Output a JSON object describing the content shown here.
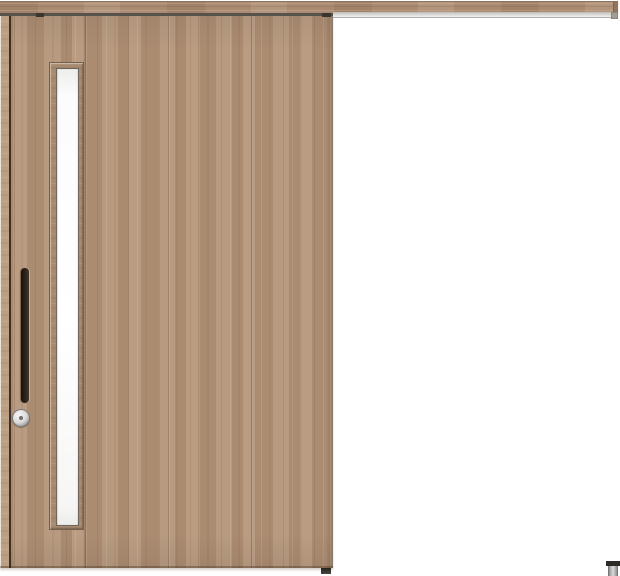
{
  "scene": {
    "type": "product-photo",
    "subject": "single outset sliding wooden door, closed, hung from full-width top rail",
    "background_color": "#ffffff"
  },
  "rail": {
    "label": "hanging-rail",
    "color": "#aa8b71",
    "underline_color": "#57524c"
  },
  "track": {
    "label": "aluminum-track",
    "color_start": "#bfbdb9",
    "color_end": "#f2f2f2",
    "end_cap_color": "#a39d96"
  },
  "door": {
    "label": "door-panel",
    "finish_color": "#b29378",
    "stile_color": "#bca083",
    "grain_dark_color": "#5f4230",
    "grain_light_color": "#e8d5c2",
    "edge_groove_color": "#3c2f25"
  },
  "window": {
    "label": "vertical-slit-window",
    "glass_color": "#fcfcfc",
    "frame_color": "#a68a70",
    "frame_line_color": "#73604f"
  },
  "handle": {
    "label": "vertical-bar-handle",
    "color": "#17100b",
    "highlight": "#44352a"
  },
  "thumbturn": {
    "label": "thumbturn-lock",
    "ring_color": "#9c9c9c",
    "face_color": "#f5f5f5",
    "pin_color": "#6f6f6f"
  },
  "hardware": {
    "hanger_color": "#3a352f"
  },
  "floor_guide": {
    "label": "floor-guide-stopper",
    "cap_color": "#2b2925",
    "body_color": "#dcdcdc"
  }
}
